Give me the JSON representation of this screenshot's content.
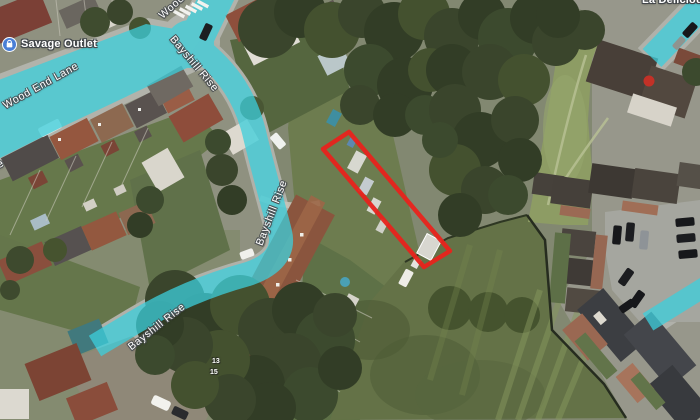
{
  "map": {
    "view": "satellite",
    "road_labels": {
      "wood_end_lane": "Wood End Lane",
      "wood_end_lane_tail": "Wood End Lane",
      "wood_partial": "Wood",
      "bayshill_rise_upper": "Bayshill Rise",
      "bayshill_rise_mid": "Bayshill Rise",
      "bayshill_rise_lower": "Bayshill Rise"
    },
    "poi_labels": {
      "savage_outlet": "Savage Outlet",
      "la_delicious": "La Delicious"
    },
    "house_numbers": {
      "n13": "13",
      "n15": "15"
    },
    "colors": {
      "route_highlight": "#3CCFDC",
      "plot_outline": "#E8231C",
      "poi_icon_bg": "#4A7FD6"
    },
    "plot_outline_points": "323,149 349,132 450,251 424,267"
  }
}
